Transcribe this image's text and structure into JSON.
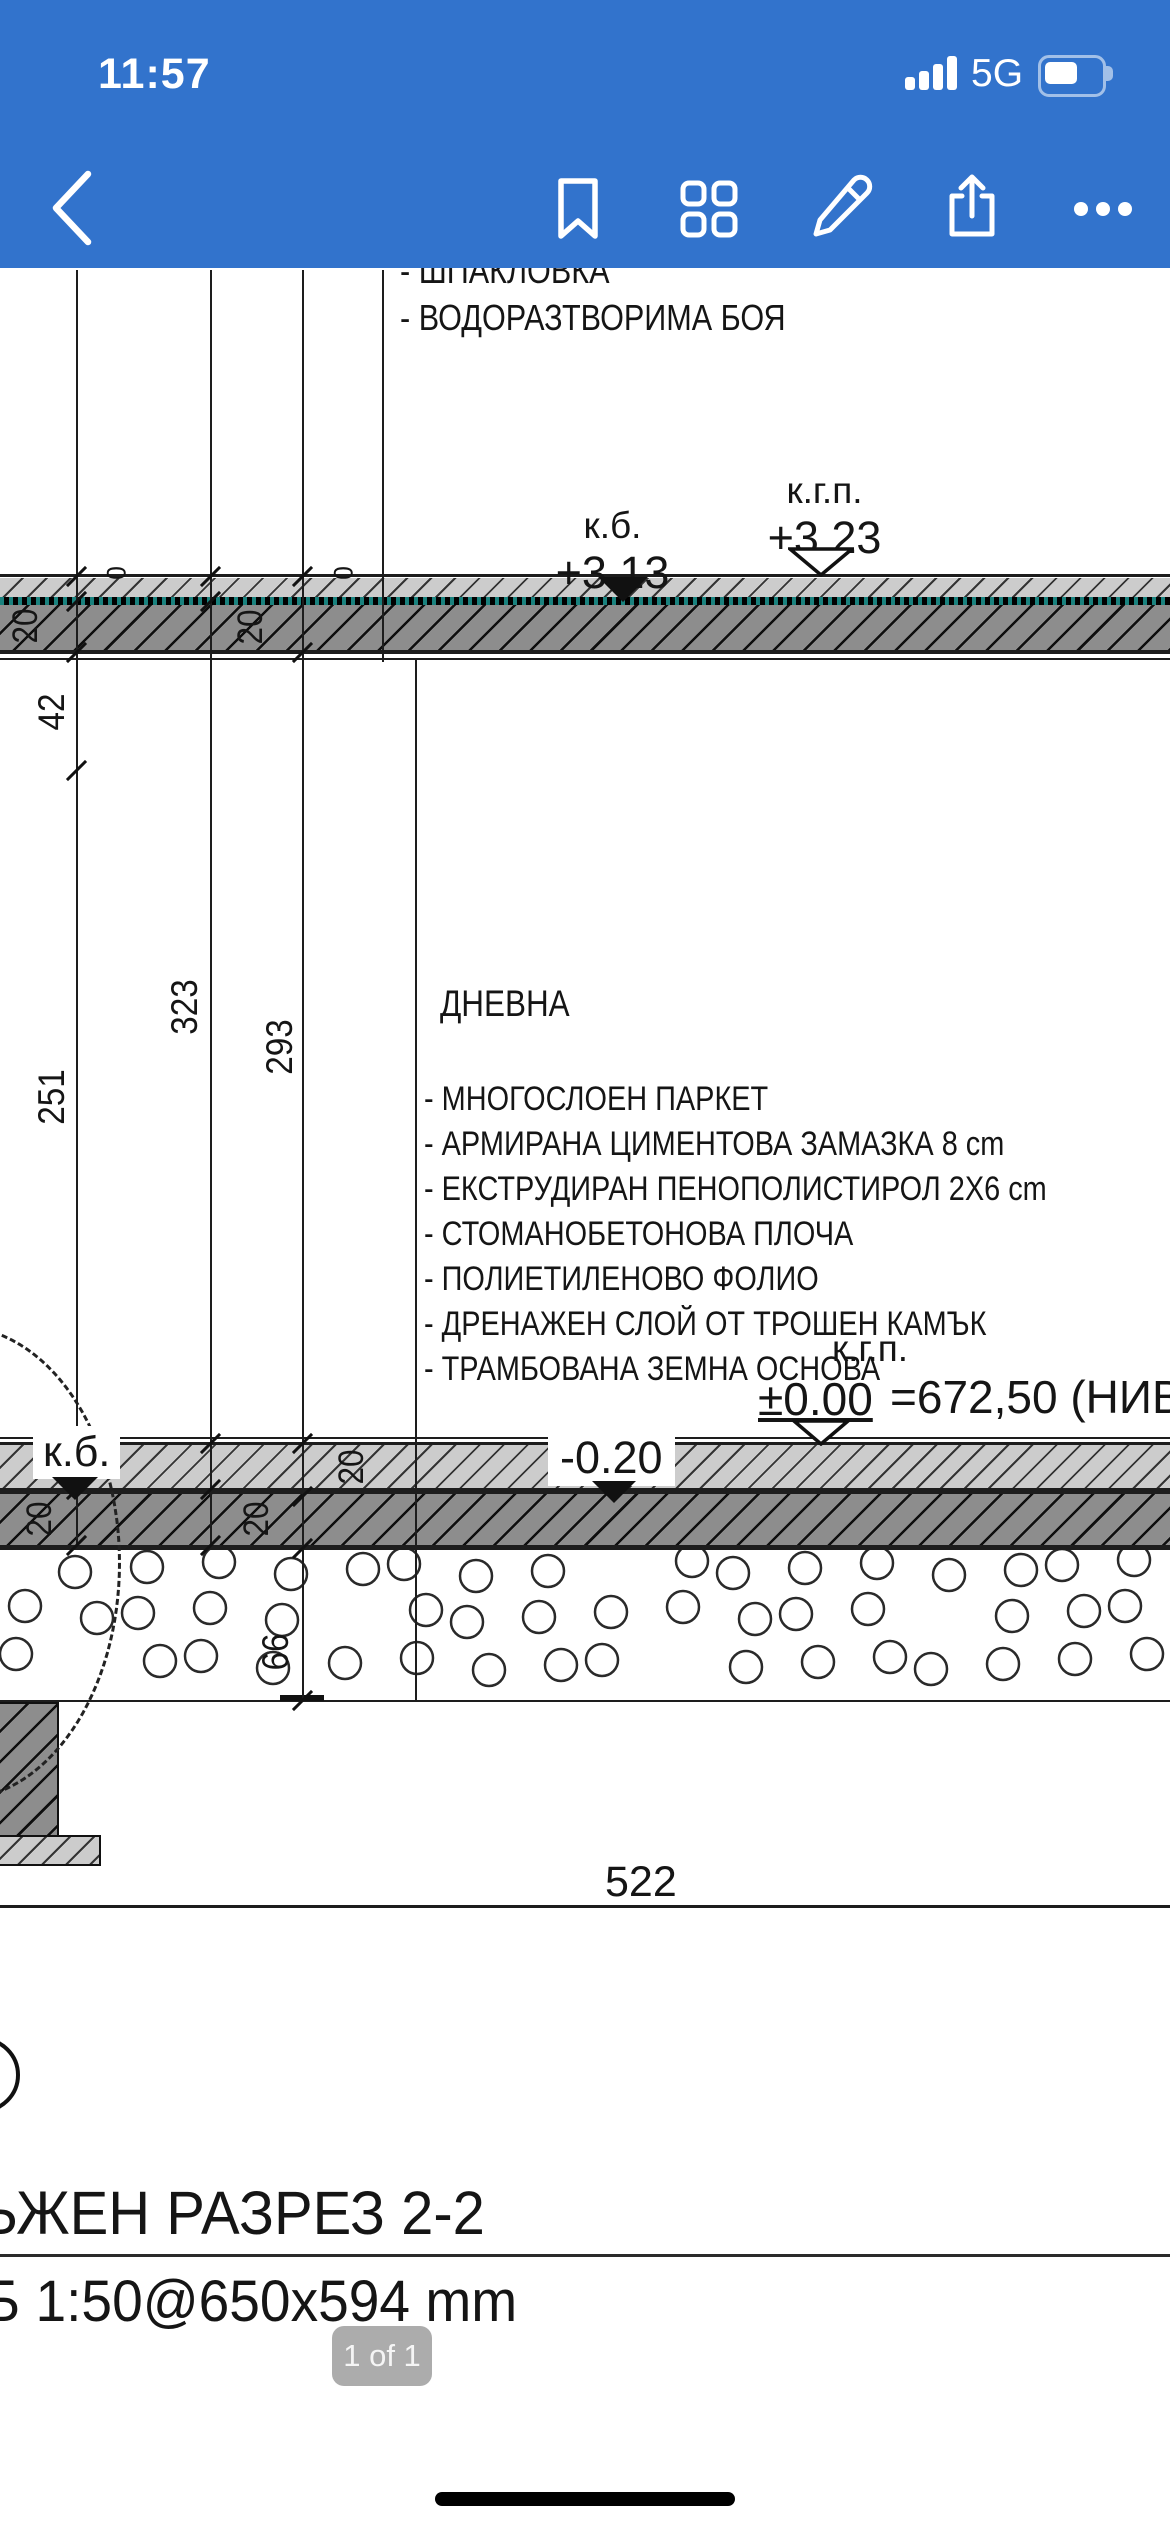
{
  "status": {
    "time": "11:57",
    "network": "5G"
  },
  "drawing": {
    "top_notes": [
      "- ШПАКЛОВКА",
      "- ВОДОРАЗТВОРИМА БОЯ"
    ],
    "room": "ДНЕВНА",
    "layers": [
      "- МНОГОСЛОЕН ПАРКЕТ",
      "- АРМИРАНА ЦИМЕНТОВА ЗАМАЗКА 8 cm",
      "- ЕКСТРУДИРАН ПЕНОПОЛИСТИРОЛ 2X6 cm",
      "- СТОМАНОБЕТОНОВА ПЛОЧА",
      "- ПОЛИЕТИЛЕНОВО ФОЛИО",
      "- ДРЕНАЖЕН СЛОЙ ОТ ТРОШЕН КАМЪК",
      "- ТРАМБОВАНА ЗЕМНА ОСНОВА"
    ],
    "levels": {
      "kb_upper_label": "к.б.",
      "kb_upper_value": "+3.13",
      "kgp_upper_label": "к.г.п.",
      "kgp_upper_value": "+3.23",
      "kb_lower_label": "к.б.",
      "minus_020": "-0.20",
      "kgp_lower_label": "к.г.п.",
      "kgp_lower_value": "±0.00",
      "kgp_lower_abs": "=672,50 (НИВ"
    },
    "dims": {
      "d42": "42",
      "d251": "251",
      "d323": "323",
      "d293": "293",
      "d522": "522",
      "d66": "66",
      "d20_up_a": "20",
      "d20_up_b": "20",
      "d0_a": "0",
      "d0_b": "0",
      "d20_low_a": "20",
      "d20_low_b": "20",
      "d20_low_c": "20"
    },
    "title": "ЬЖЕН РАЗРЕЗ 2-2",
    "subtitle": "Б 1:50@650x594 mm"
  },
  "pager": {
    "label": "1 of 1"
  },
  "colors": {
    "header_blue": "#3273cc"
  }
}
